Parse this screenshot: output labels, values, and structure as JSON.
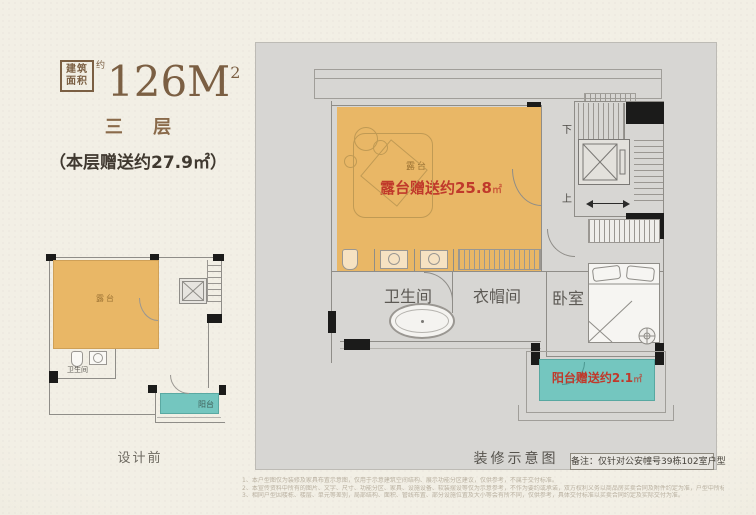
{
  "header": {
    "area_box": {
      "line1": "建筑",
      "line2": "面积",
      "approx": "约"
    },
    "area_value": "126M",
    "area_sup": "2",
    "floor_label": "三 层",
    "bonus_label": "（本层赠送约27.9㎡）"
  },
  "before_plan": {
    "terrace_label": "露台",
    "bathroom_label": "卫生间",
    "balcony_label": "阳台",
    "caption": "设计前"
  },
  "after_plan": {
    "terrace_label": "露台",
    "terrace_gift_text": "露台赠送约25.8",
    "terrace_gift_unit": "㎡",
    "stairs_down_label": "下",
    "stairs_up_label": "上",
    "bathroom_label": "卫生间",
    "cloakroom_label": "衣帽间",
    "bedroom_label": "卧室",
    "balcony_gift_text": "阳台赠送约2.1",
    "balcony_gift_unit": "㎡",
    "caption": "装修示意图",
    "note": "备注：仅针对公安幢号39栋102室户型"
  },
  "footnotes": [
    "1、本户型图仅为装修及家具布置示意图，仅用于示意建筑空间结构、展示功能分区建议，仅供参考，不属于交付标准。",
    "2、本宣传资料中所有的图片、文字、尺寸、功能分区、家具、设施设备、软装摆设等仅为示意参考，不作为要约或承诺，双方权利义务以商品房买卖合同及附件约定为准，户型中所标示尺寸仅为设计参考，相关尺寸仅供参考，具体面积及尺寸以政府部门最终测绘成果及双方签订的商品房买卖合同约定为准并以实际交付为准。",
    "3、相同户型因楼栋、楼层、单元等差别，局部结构、面积、管线布置、部分设施位置及大小等会有所不同，仅供参考，具体交付标准以买卖合同约定及实际交付为准。"
  ],
  "colors": {
    "paper": "#f1eee3",
    "panel_gray": "#d7d6d3",
    "terrace_orange": "#e9b766",
    "balcony_teal": "#74c6bf",
    "gift_red": "#c0392b",
    "brand_brown": "#7b5f43",
    "wall_gray": "#8f8d88",
    "wall_black": "#1b1b1a"
  }
}
